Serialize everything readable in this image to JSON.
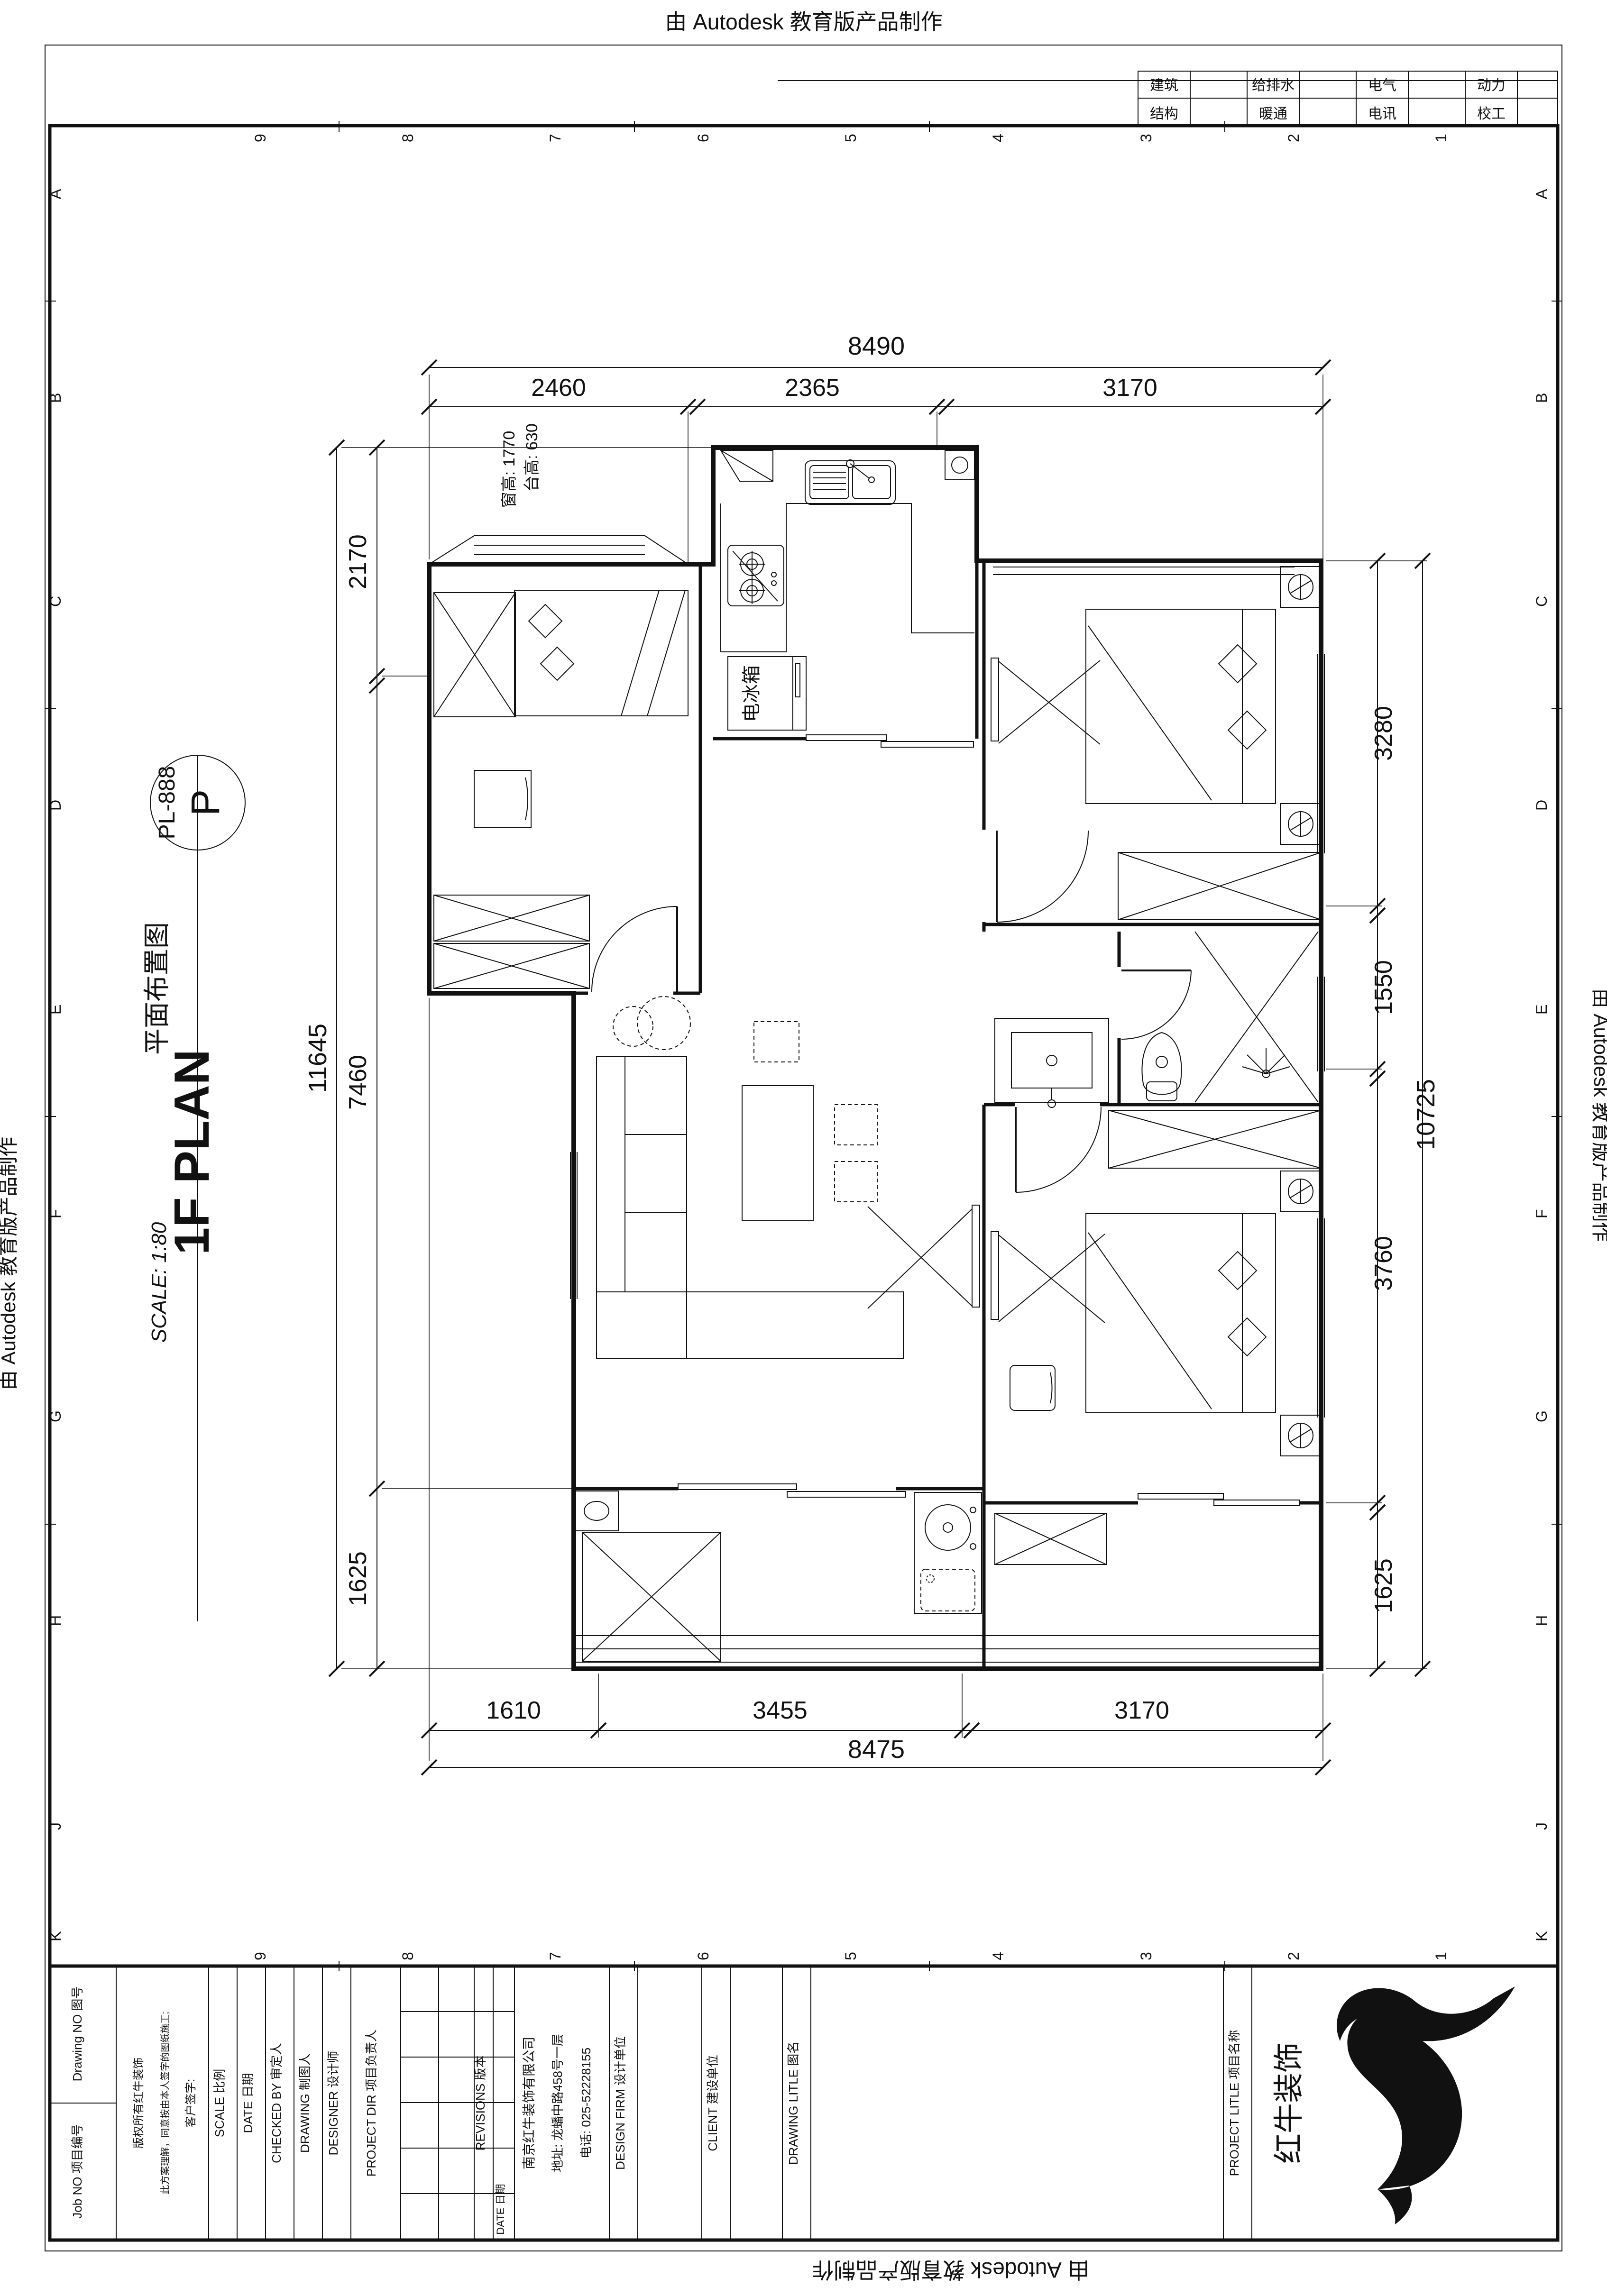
{
  "banner": {
    "text": "由 Autodesk 教育版产品制作"
  },
  "discipline_table": {
    "row1": [
      "建筑",
      "给排水",
      "电气",
      "动力"
    ],
    "row2": [
      "结构",
      "暖通",
      "电讯",
      "校工"
    ]
  },
  "drawing_label": {
    "code": "PL-888",
    "letter": "P",
    "title_cn": "平面布置图",
    "title_en": "1F PLAN",
    "scale": "SCALE: 1:80"
  },
  "annotations": {
    "counter_height": "台高: 630",
    "window_height": "窗高: 1770",
    "fridge": "电冰箱"
  },
  "dimensions": {
    "top": {
      "total": "8490",
      "segments": [
        "2460",
        "2365",
        "3170"
      ]
    },
    "bottom": {
      "total": "8475",
      "segments": [
        "1610",
        "3455",
        "3170"
      ]
    },
    "left": {
      "total": "11645",
      "segments": [
        "2170",
        "7460",
        "1625"
      ]
    },
    "right": {
      "total": "10725",
      "segments": [
        "3280",
        "1550",
        "3760",
        "1625"
      ]
    }
  },
  "grid_refs": {
    "numbers": [
      "9",
      "8",
      "7",
      "6",
      "5",
      "4",
      "3",
      "2",
      "1"
    ],
    "letters": [
      "A",
      "B",
      "C",
      "D",
      "E",
      "F",
      "G",
      "H",
      "J",
      "K"
    ]
  },
  "title_block": {
    "drawing_no": "Drawing NO 图号",
    "job_no": "Job NO 项目编号",
    "disclaimer_line1": "版权所有红牛装饰",
    "disclaimer_line2": "此方案理解，同意按由本人签字的图纸施工;",
    "disclaimer_line3": "客户签字:",
    "scale": "SCALE 比例",
    "date": "DATE 日期",
    "checked_by": "CHECKED BY 审定人",
    "drawing": "DRAWING 制图人",
    "designer": "DESIGNER 设计师",
    "project_dir": "PROJECT DIR 项目负责人",
    "revisions": "REVISIONS 版本",
    "revisions_date": "DATE 日期",
    "company": "南京红牛装饰有限公司",
    "address": "地址: 龙蟠中路458号一层",
    "phone": "电话: 025-52228155",
    "design_firm": "DESIGN FIRM 设计单位",
    "client": "CLIENT 建设单位",
    "drawing_title": "DRAWING LITLE 图名",
    "project_title": "PROJECT LITLE 项目名称",
    "logo_text": "红牛装饰"
  }
}
